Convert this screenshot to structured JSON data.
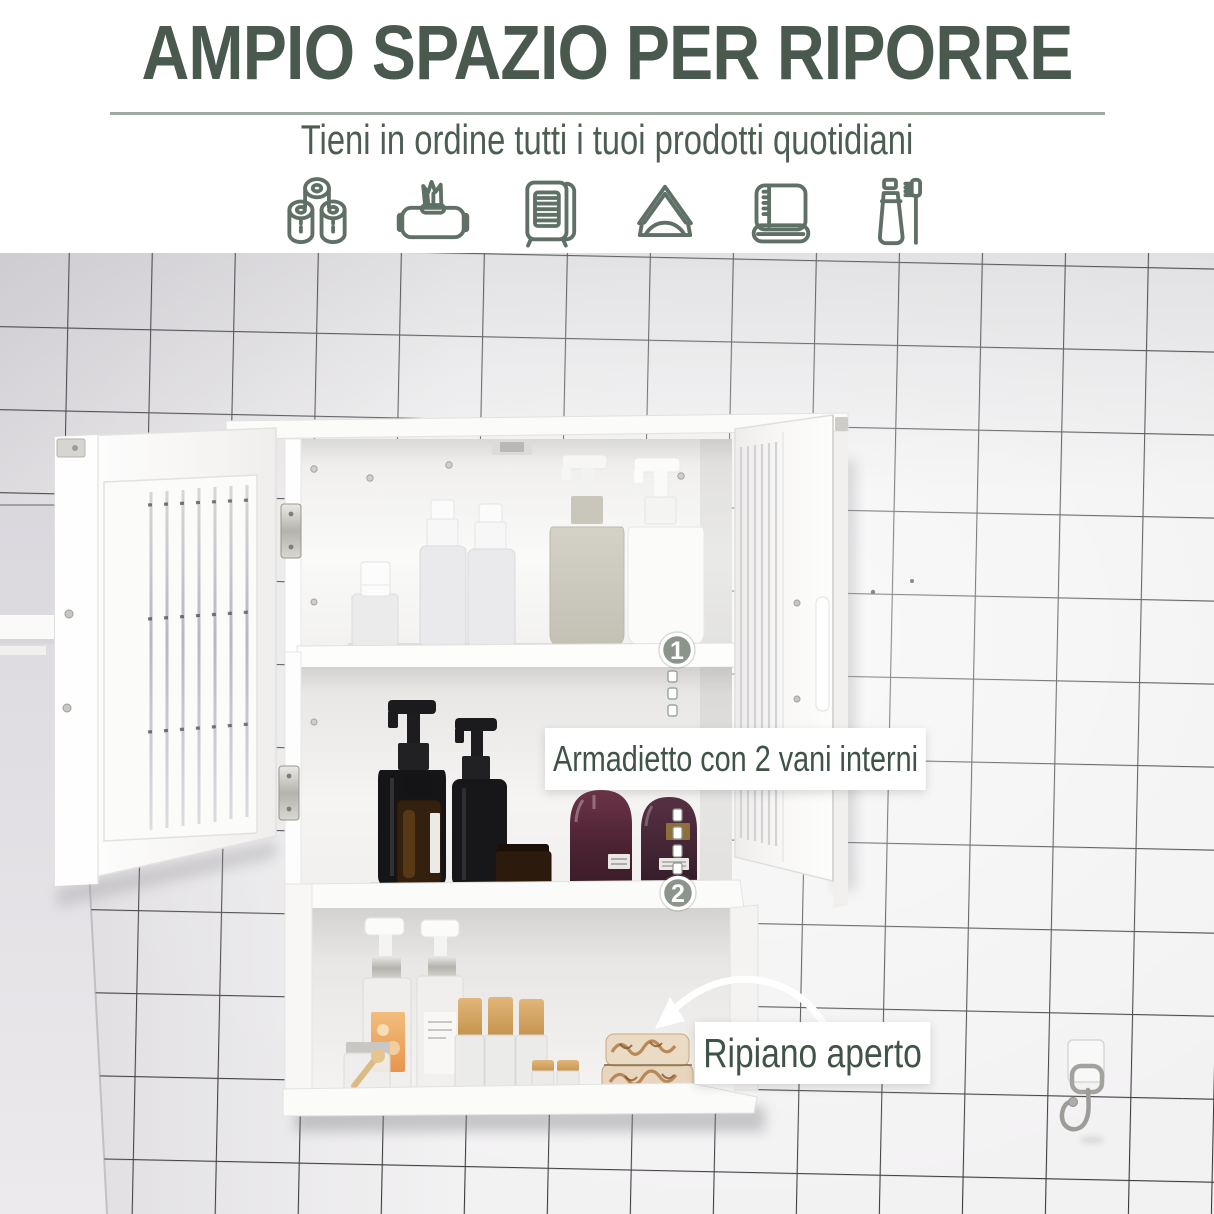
{
  "header": {
    "title": "AMPIO SPAZIO PER RIPORRE",
    "subtitle": "Tieni in ordine tutti i tuoi prodotti quotidiani"
  },
  "feature_icons": [
    "toilet-paper-rolls",
    "wet-wipes-pack",
    "tissue-dispenser",
    "napkin-holder",
    "folded-towel",
    "toothpaste-and-toothbrush"
  ],
  "annotations": {
    "marker1": "1",
    "marker2": "2",
    "cabinet_label": "Armadietto con 2 vani interni",
    "shelf_label": "Ripiano aperto"
  },
  "colors": {
    "accent_text": "#49594e",
    "subtitle_text": "#4c5e52",
    "label_text": "#3f5347",
    "divider": "#9caaa1",
    "badge_fill": "#8b958c",
    "grout": "#39383b",
    "tile": "#f3f2f3",
    "cabinet_white": "#fbfbfa"
  }
}
